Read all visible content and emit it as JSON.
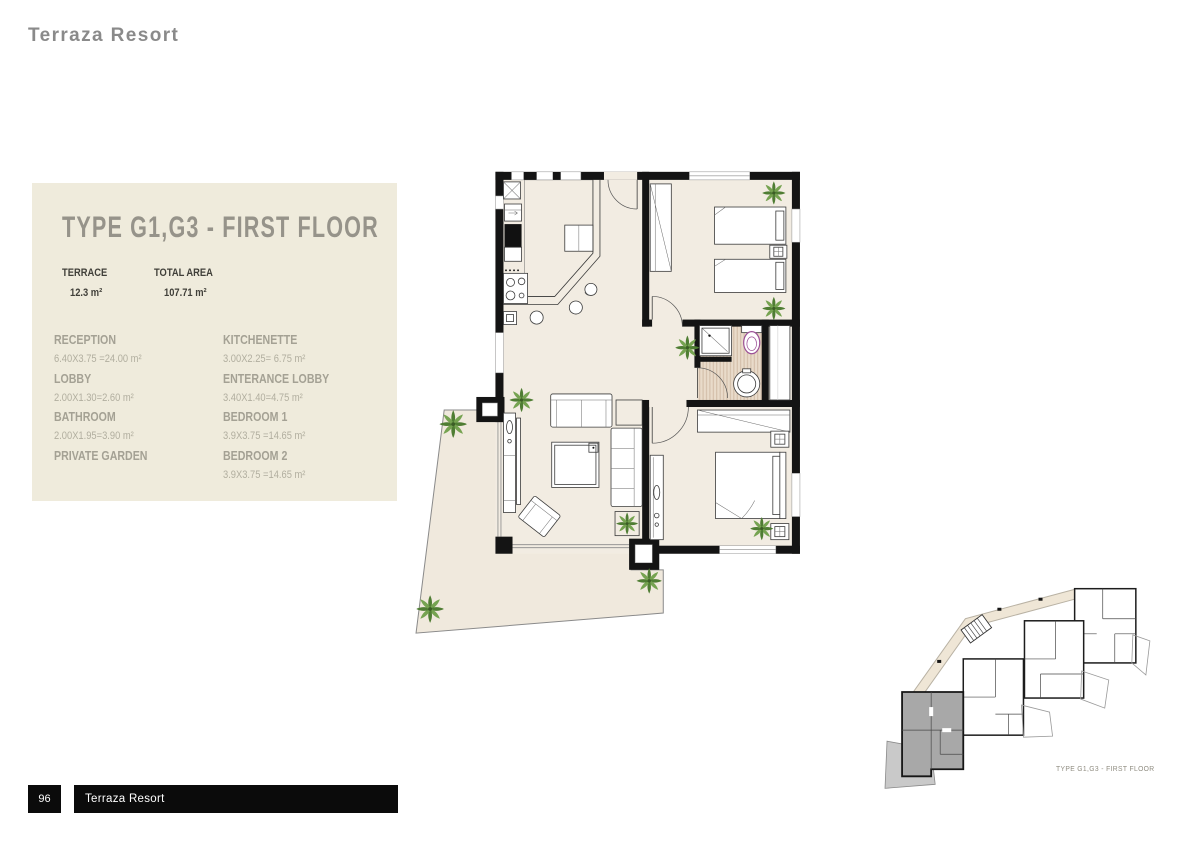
{
  "page": {
    "title": "Terraza Resort",
    "page_number": "96",
    "footer_label": "Terraza Resort"
  },
  "info_panel": {
    "title": "TYPE G1,G3 - FIRST FLOOR",
    "summary": [
      {
        "label": "TERRACE",
        "value": "12.3 m²"
      },
      {
        "label": "TOTAL AREA",
        "value": "107.71 m²"
      }
    ],
    "rooms_left": [
      {
        "name": "RECEPTION",
        "dims": "6.40X3.75 =24.00 m²"
      },
      {
        "name": "LOBBY",
        "dims": "2.00X1.30=2.60 m²"
      },
      {
        "name": "BATHROOM",
        "dims": "2.00X1.95=3.90 m²"
      },
      {
        "name": "PRIVATE GARDEN",
        "dims": ""
      }
    ],
    "rooms_right": [
      {
        "name": "KITCHENETTE",
        "dims": "3.00X2.25= 6.75 m²"
      },
      {
        "name": "ENTERANCE LOBBY",
        "dims": "3.40X1.40=4.75 m²"
      },
      {
        "name": "BEDROOM 1",
        "dims": "3.9X3.75 =14.65 m²"
      },
      {
        "name": "BEDROOM 2",
        "dims": "3.9X3.75 =14.65 m²"
      }
    ]
  },
  "key_plan": {
    "caption": "TYPE G1,G3 - FIRST FLOOR"
  },
  "colors": {
    "panel_bg": "#efebdc",
    "heading_gray": "#8a8a8a",
    "panel_title": "#96938a",
    "room_name": "#a4a194",
    "room_dims": "#b1ae9f",
    "summary_text": "#403f39",
    "floor": "#f2ece2",
    "garden": "#f0e9dd",
    "wood": "#e7d8c6",
    "wood_stripe": "#cbb29a",
    "wall": "#141414",
    "plant_light": "#76a351",
    "plant_dark": "#4f7d33",
    "toilet_accent": "#9b4f96",
    "keyplan_unit": "#a8a8a8",
    "keyplan_terrace": "#c9c9c9",
    "corridor": "#efe6d6",
    "footer_bg": "#0b0b0b",
    "footer_text": "#ffffff"
  }
}
